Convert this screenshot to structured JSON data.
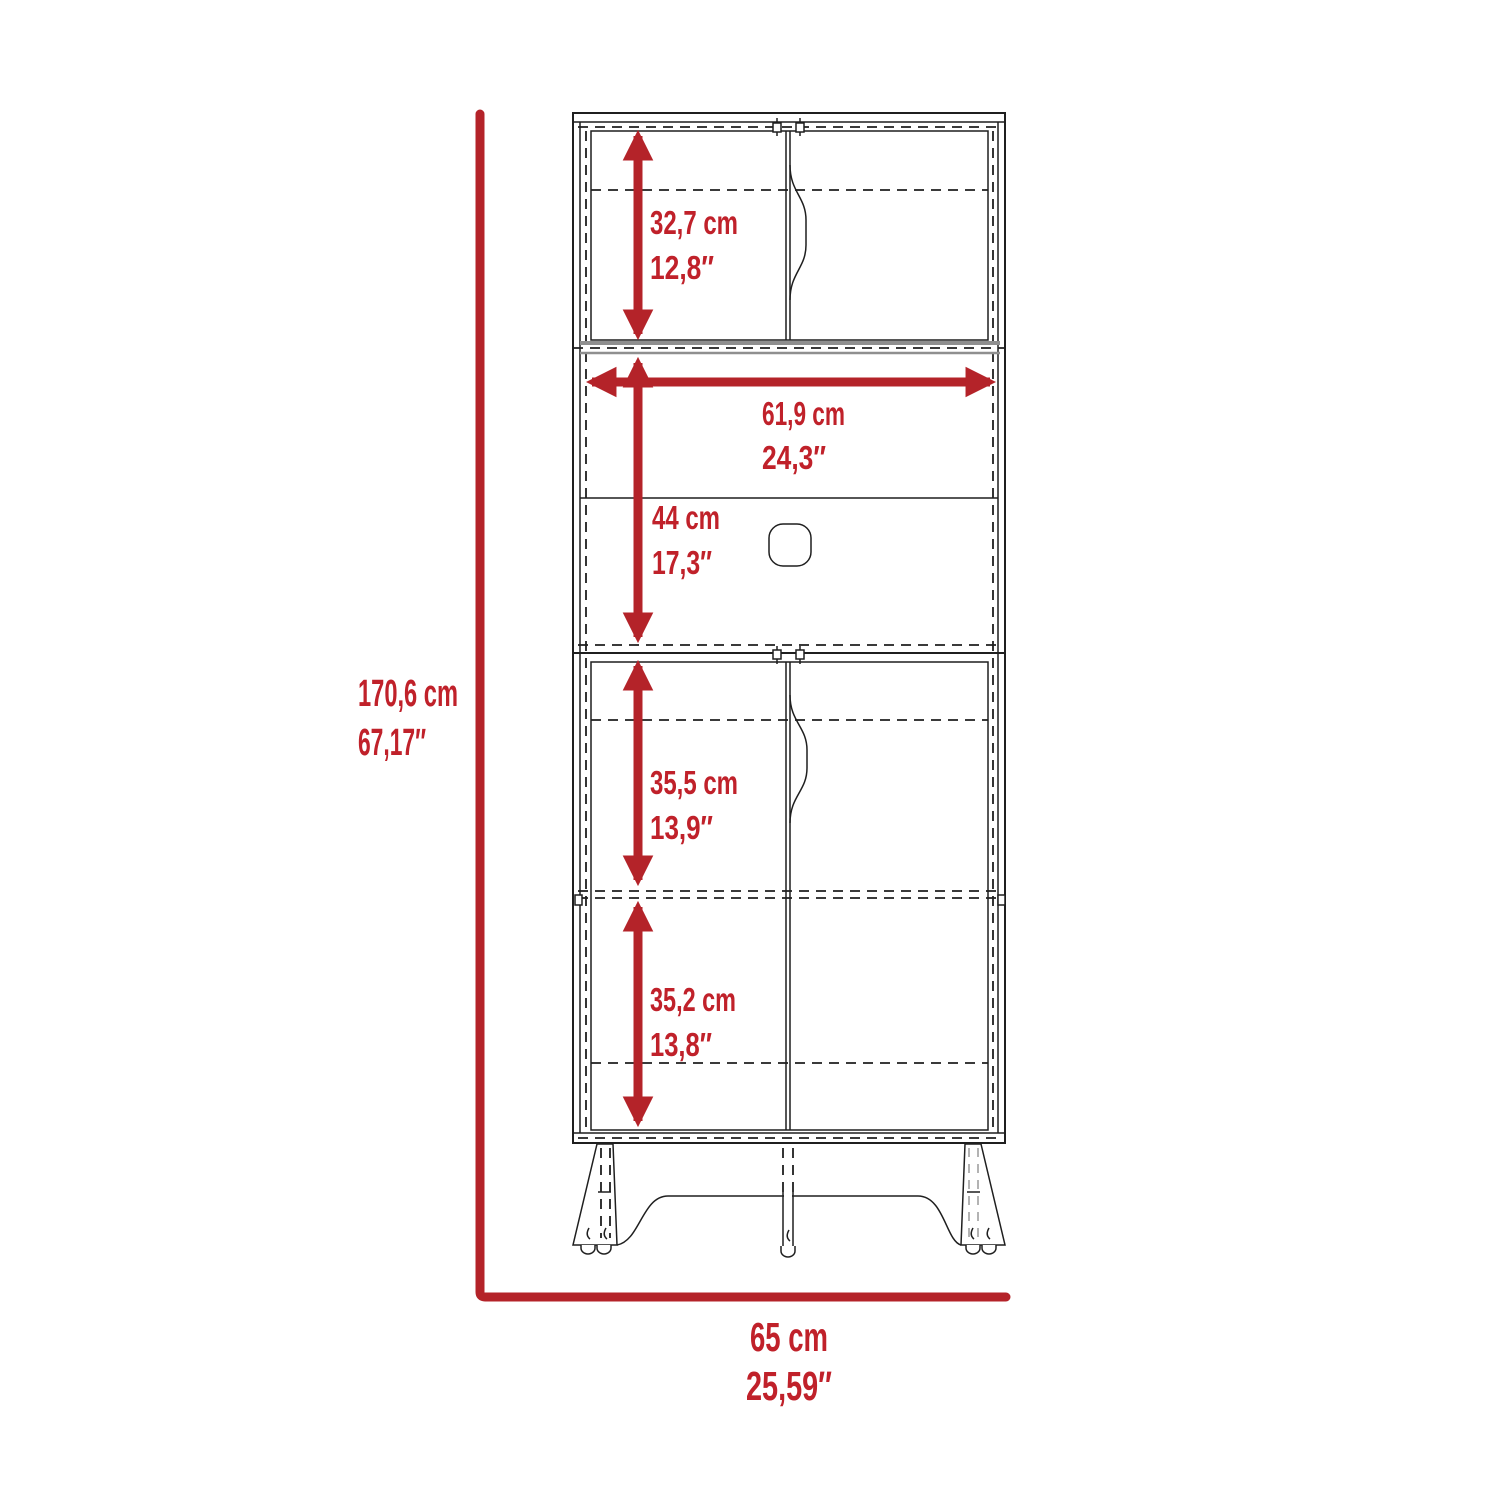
{
  "diagram": {
    "type": "furniture-dimension-diagram",
    "subject": "tall pantry cabinet with hutch doors, open microwave shelf and lower double doors"
  },
  "colors": {
    "dimension_red": "#b42329",
    "label_red": "#c0212a",
    "outline_black": "#1f1f1f",
    "panel_gray": "#8f8f8f",
    "background": "#ffffff"
  },
  "dimensions": {
    "overall_height": {
      "cm": "170,6 cm",
      "in": "67,17″"
    },
    "overall_width": {
      "cm": "65 cm",
      "in": "25,59″"
    },
    "hutch_interior_height": {
      "cm": "32,7 cm",
      "in": "12,8″"
    },
    "interior_width": {
      "cm": "61,9 cm",
      "in": "24,3″"
    },
    "open_section_height": {
      "cm": "44 cm",
      "in": "17,3″"
    },
    "upper_lower_cabinet_height": {
      "cm": "35,5 cm",
      "in": "13,9″"
    },
    "bottom_lower_cabinet_height": {
      "cm": "35,2 cm",
      "in": "13,8″"
    }
  }
}
